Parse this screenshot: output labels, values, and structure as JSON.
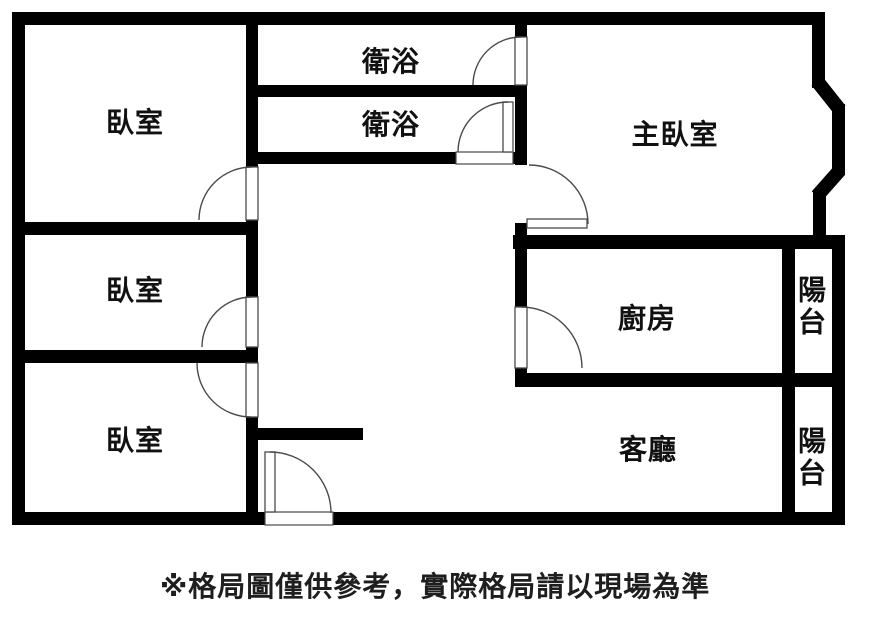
{
  "plan": {
    "colors": {
      "background": "#ffffff",
      "wall": "#000000",
      "door": "#4a4a4a",
      "label": "#111111"
    },
    "rooms": [
      {
        "name": "bedroom-1",
        "label": "臥室"
      },
      {
        "name": "bathroom-1",
        "label": "衛浴"
      },
      {
        "name": "bathroom-2",
        "label": "衛浴"
      },
      {
        "name": "master-bedroom",
        "label": "主臥室"
      },
      {
        "name": "bedroom-2",
        "label": "臥室"
      },
      {
        "name": "kitchen",
        "label": "廚房"
      },
      {
        "name": "balcony-1",
        "label": "陽台"
      },
      {
        "name": "bedroom-3",
        "label": "臥室"
      },
      {
        "name": "living-room",
        "label": "客廳"
      },
      {
        "name": "balcony-2",
        "label": "陽台"
      }
    ],
    "disclaimer": "※格局圖僅供參考，實際格局請以現場為準"
  }
}
